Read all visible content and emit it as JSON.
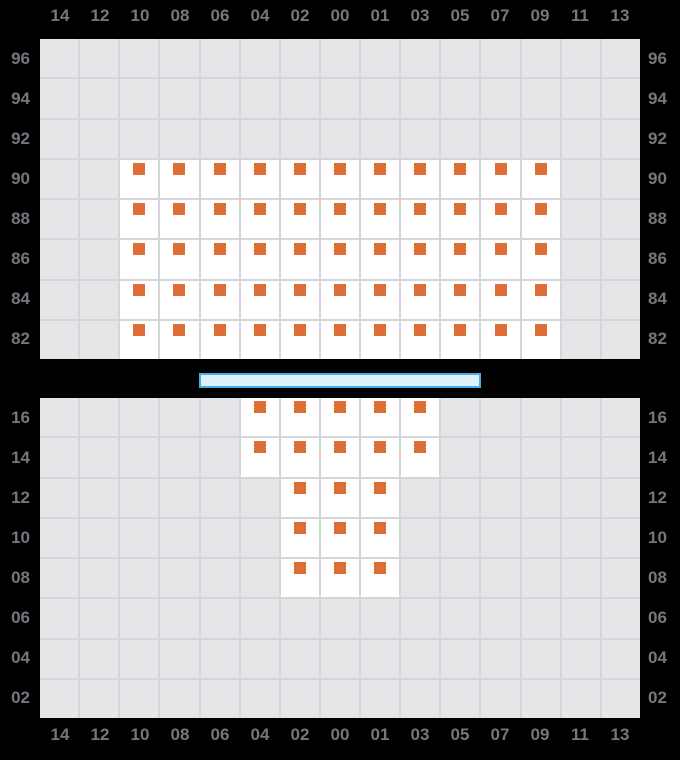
{
  "colors": {
    "background": "#000000",
    "cell_empty": "#e6e6e8",
    "cell_available": "#ffffff",
    "gridline": "#d6d6da",
    "marker": "#de6e38",
    "label_text": "#76767f",
    "bar_fill": "#def0fb",
    "bar_border": "#45aee6"
  },
  "column_labels": [
    "14",
    "12",
    "10",
    "08",
    "06",
    "04",
    "02",
    "00",
    "01",
    "03",
    "05",
    "07",
    "09",
    "11",
    "13"
  ],
  "upper_grid": {
    "row_labels": [
      "96",
      "94",
      "92",
      "90",
      "88",
      "86",
      "84",
      "82"
    ],
    "rows": [
      "000000000000000",
      "000000000000000",
      "000000000000000",
      "002222222222200",
      "002222222222200",
      "002222222222200",
      "002222222222200",
      "002222222222200"
    ]
  },
  "lower_grid": {
    "row_labels": [
      "16",
      "14",
      "12",
      "10",
      "08",
      "06",
      "04",
      "02"
    ],
    "rows": [
      "000002222200000",
      "000002222200000",
      "000000222000000",
      "000000222000000",
      "000000222000000",
      "000000000000000",
      "000000000000000",
      "000000000000000"
    ]
  }
}
